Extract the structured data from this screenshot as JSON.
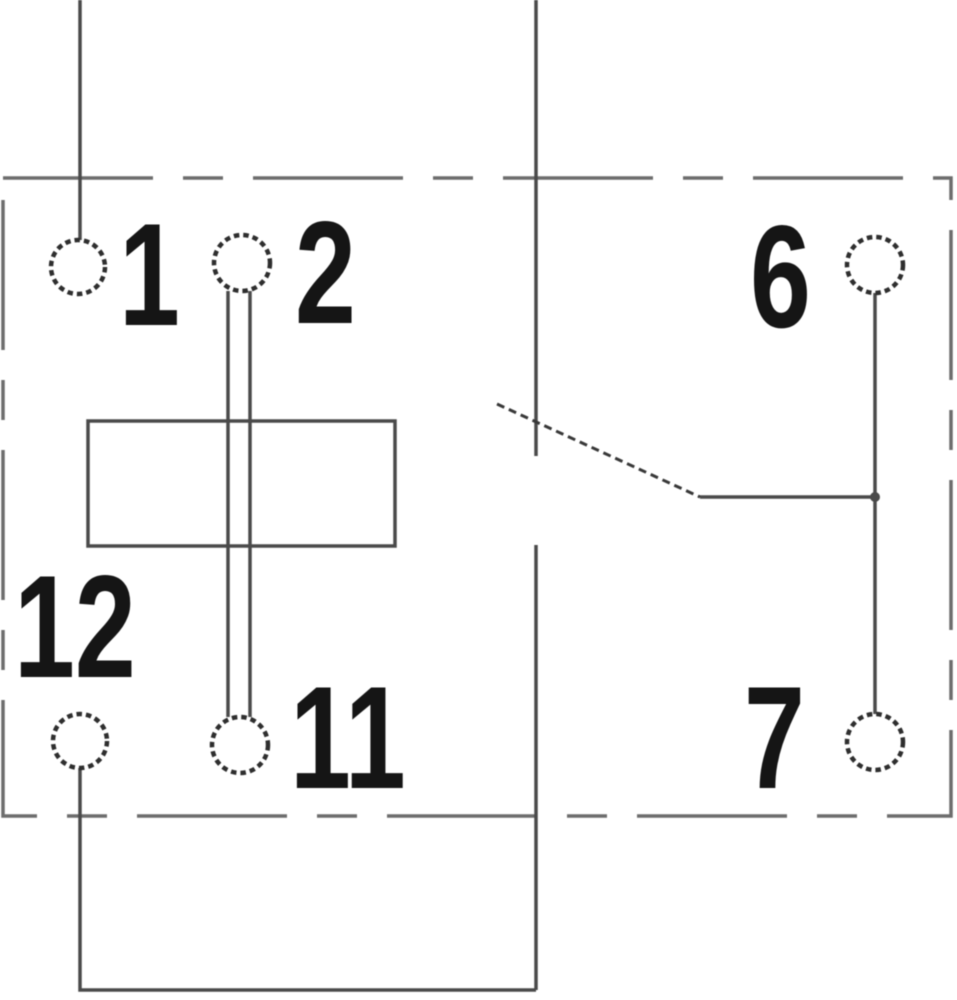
{
  "figure": {
    "type": "relay-pin-wiring-diagram",
    "background_color": "#ffffff",
    "wire_color": "#4a4a4a",
    "outline_color": "#6d6d6d",
    "contact_color": "#383838",
    "circle_color": "#2e2e2e",
    "label_color": "#151515",
    "terminals": [
      {
        "id": "1",
        "label": "1"
      },
      {
        "id": "2",
        "label": "2"
      },
      {
        "id": "6",
        "label": "6"
      },
      {
        "id": "7",
        "label": "7"
      },
      {
        "id": "11",
        "label": "11"
      },
      {
        "id": "12",
        "label": "12"
      }
    ]
  }
}
